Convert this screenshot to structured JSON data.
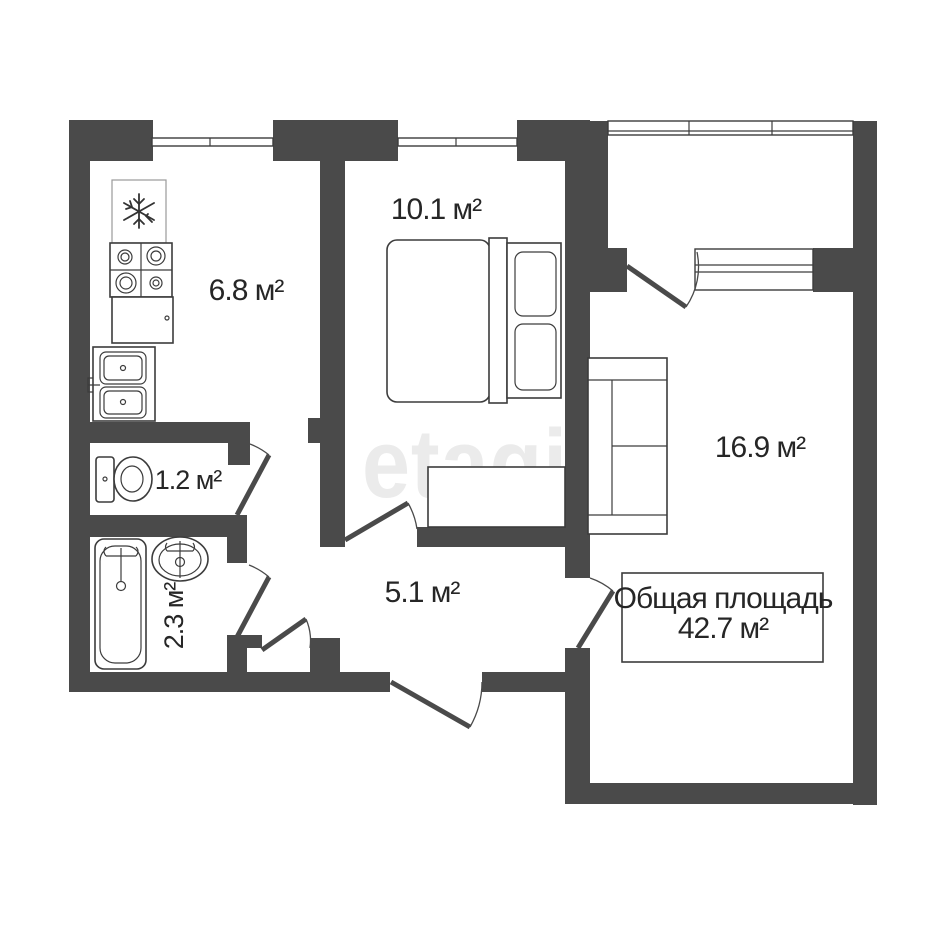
{
  "watermark": "etagi",
  "total_area": {
    "label": "Общая площадь",
    "value": "42.7 м²"
  },
  "rooms": {
    "kitchen": {
      "area": "6.8 м²"
    },
    "bedroom": {
      "area": "10.1 м²"
    },
    "living_room": {
      "area": "16.9 м²"
    },
    "hallway": {
      "area": "5.1 м²"
    },
    "toilet": {
      "area": "1.2 м²"
    },
    "bathroom": {
      "area": "2.3 м²"
    }
  },
  "fixtures": [
    "fridge",
    "stove",
    "kitchen-counter",
    "kitchen-double-sink",
    "toilet",
    "bathtub",
    "wash-basin",
    "double-bed",
    "wardrobe",
    "sofa"
  ],
  "colors": {
    "wall": "#4a4a4a",
    "line": "#3c3c3c",
    "text": "#262626",
    "watermark": "#ebebeb",
    "bg": "#ffffff"
  }
}
